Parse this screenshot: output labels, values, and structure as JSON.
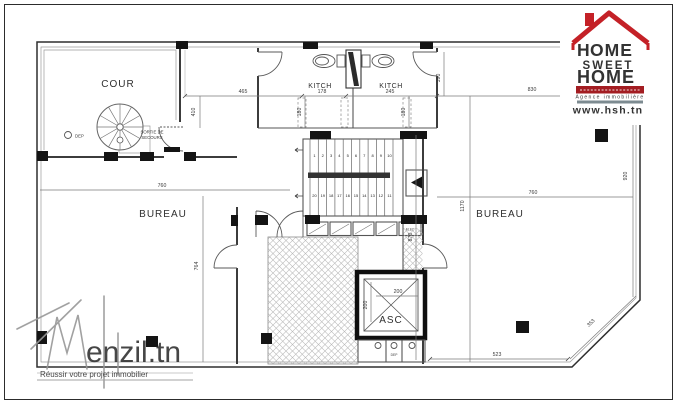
{
  "hsh_logo": {
    "home_top_h": "H",
    "home_top_rest": "OME",
    "sweet": "SWEET",
    "home_bottom_h": "H",
    "home_bottom_rest": "OME",
    "agency_line": "Agence immobilière",
    "website": "www.hsh.tn",
    "accent_red": "#c42127",
    "dark": "#1a1a1a"
  },
  "menzil_watermark": {
    "name": "enzil.tn",
    "tagline": "Réussir votre projet immobilier",
    "gray": "#8a8a8a"
  },
  "rooms": {
    "cour": "COUR",
    "bureau_left": "BUREAU",
    "bureau_right": "BUREAU",
    "kitch_left": "KITCH",
    "kitch_right": "KITCH",
    "asc": "ASC",
    "sortie_line1": "SORTIE DE",
    "sortie_line2": "SECOURS",
    "dep_cour": "DEP",
    "dep_asc": "DEP",
    "elec": "ELEC"
  },
  "dimensions": {
    "top_left_width": "465",
    "top_left_height": "410",
    "kitch_left_width": "178",
    "kitch_right_width": "245",
    "duct_left": "180",
    "duct_right": "180",
    "kitch_depth": "390",
    "top_right_width": "830",
    "bureau_left_width": "760",
    "bureau_left_height": "764",
    "bureau_right_width": "760",
    "bureau_right_height": "920",
    "core_height_total": "1170",
    "core_height": "870",
    "asc_width": "200",
    "asc_depth": "200",
    "bottom_right_width": "523",
    "chamfer_length": "353"
  },
  "stairs": {
    "up_flight": [
      "1",
      "2",
      "3",
      "4",
      "5",
      "6",
      "7",
      "8",
      "9",
      "10"
    ],
    "down_flight": [
      "20",
      "19",
      "18",
      "17",
      "16",
      "15",
      "14",
      "13",
      "12",
      "11"
    ]
  }
}
